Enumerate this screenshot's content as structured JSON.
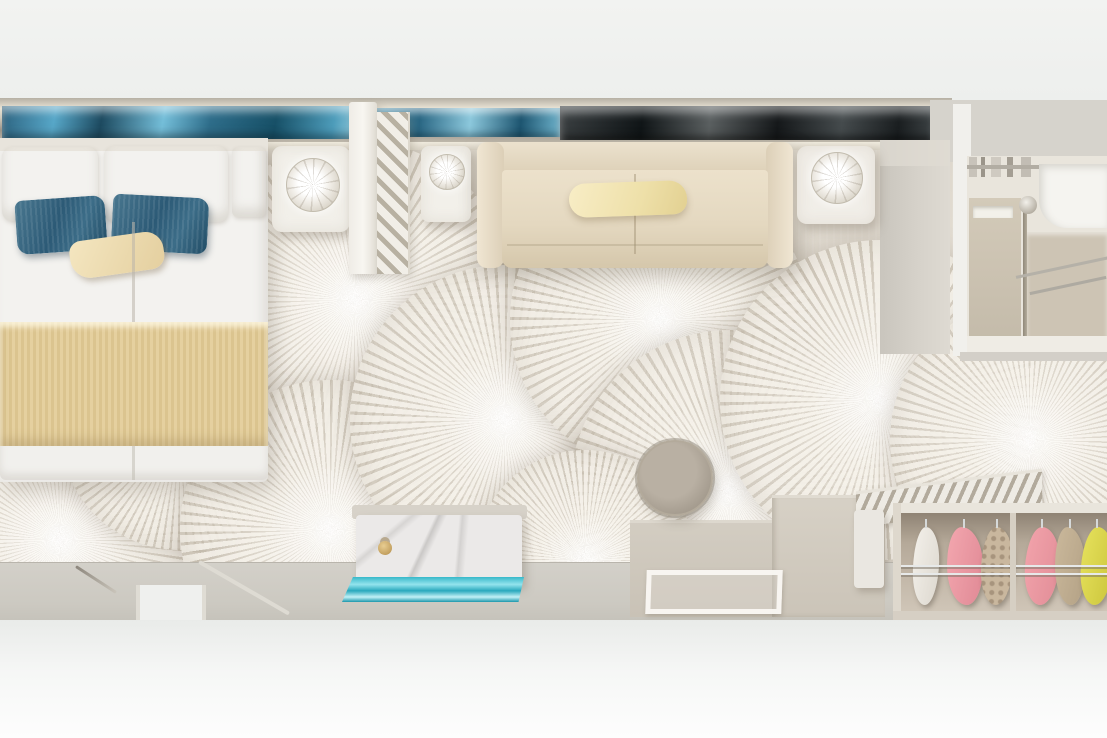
{
  "meta": {
    "description": "Photorealistic top-down 3D rendering of a cruise ship cabin suite floor plan; no text is visible in the image",
    "view": "top-down orthographic render",
    "image_size": {
      "width": 1107,
      "height": 738
    }
  },
  "scene": {
    "labels": {
      "cabin": "cabin-suite-top-view",
      "balcony_window": "balcony window strip with sea reflections",
      "bed": "double bed with white duvet, two teal pillows, beige accent pillow and tan ribbed runner",
      "nightstand_left": "white nightstand with round glass lamp",
      "partition": "louvered privacy partition",
      "nightstand_mid": "small white side table with lamp",
      "sofa": "cream three-seat sofa with cream throw pillow",
      "side_table_right": "white side table with round glass lamp",
      "bathroom": "bathroom with vanity, chrome fixtures and white tub",
      "carpet": "ivory carpet with large radial fan medallion pattern",
      "vanity_desk": "marble-top vanity desk with gold knob and turquoise glass bench",
      "stool": "round taupe ottoman stool",
      "desk_counter": "built-in desk counter unit",
      "acrylic_table": "clear acrylic side table frame",
      "closet": "open wardrobe with hanging garments",
      "garments": "hanging clothes: white, pink, floral beige, pink, taupe, yellow",
      "slat_shelf": "slatted luggage shelf",
      "mini_cabinet": "narrow white cabinet",
      "entry_floor": "gray entry corridor floor with doorway threshold",
      "rod": "thin metal rod on floor"
    },
    "palette": {
      "page_white": "#fdfdfd",
      "band_white": "#f1f2f0",
      "floor_gray": "#cfccc4",
      "wall_gray": "#d6d3cc",
      "carpet_base": "#e2dcd1",
      "carpet_line": "#aca294",
      "sea_blue": "#57a7c8",
      "sea_dark": "#15181a",
      "chrome": "#cfc9bb",
      "bed_white": "#f3f2ef",
      "pillow_teal": "#2f6180",
      "pillow_beige": "#ecd9b4",
      "blanket_tan": "#e0cb97",
      "sofa_cream": "#e4d8c0",
      "sofa_pillow": "#eee0a9",
      "marble": "#ebe9e8",
      "gold_knob": "#c4a160",
      "glass_teal": "#37b8c9",
      "stool_taupe": "#a49b8e",
      "desk_tan": "#ccc5ba",
      "closet_shadow": "#8f8374",
      "garment_pink": "#ec9ba4",
      "garment_yellow": "#d9d44c",
      "garment_taupe": "#c0ae92",
      "garment_white": "#efece7"
    }
  }
}
